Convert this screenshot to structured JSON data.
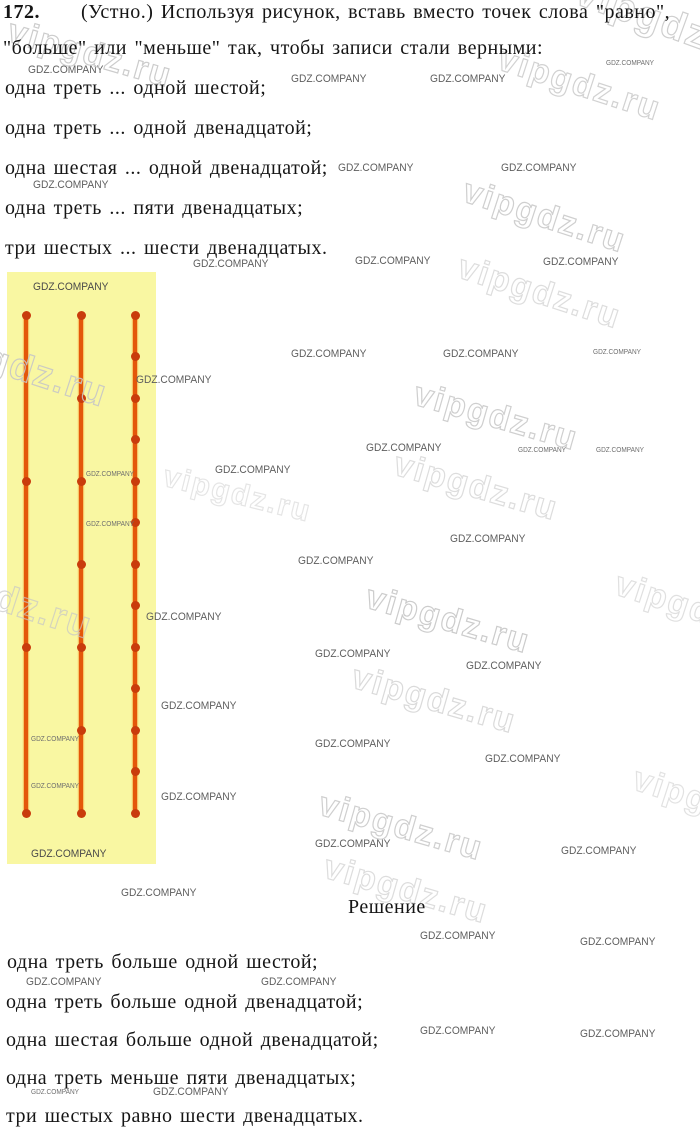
{
  "page": {
    "problem_number": "172.",
    "header_line1": "(Устно.) Используя рисунок, вставь вместо точек слова \"равно\",",
    "header_line2": "\"больше\" или \"меньше\" так, чтобы записи стали верными:",
    "conditions": [
      "одна треть ... одной шестой;",
      "одна треть ... одной двенадцатой;",
      "одна шестая ... одной двенадцатой;",
      "одна треть ... пяти двенадцатых;",
      "три шестых ... шести двенадцатых."
    ],
    "solution_title": "Решение",
    "solutions": [
      "одна треть больше одной шестой;",
      "одна треть больше одной двенадцатой;",
      "одна шестая больше одной двенадцатой;",
      "одна треть меньше пяти двенадцатых;",
      "три шестых равно шести двенадцатых."
    ]
  },
  "figure": {
    "description": "three vertical number lines of equal length divided by dots into thirds, sixths and twelfths",
    "background_color": "#f9f7a2",
    "line_color": "#e4570a",
    "dot_color": "#c93c0c",
    "line_x_centers": [
      19,
      74,
      128
    ],
    "line_top": 43,
    "line_length": 498,
    "lines": [
      {
        "name": "thirds-line",
        "divisions": 3
      },
      {
        "name": "sixths-line",
        "divisions": 6
      },
      {
        "name": "twelfths-line",
        "divisions": 12
      }
    ]
  },
  "watermarks": {
    "company": "GDZ.COMPANY",
    "site": "vipgdz.ru",
    "company_stamps": [
      {
        "x": 28,
        "y": 64,
        "size": "n"
      },
      {
        "x": 291,
        "y": 73,
        "size": "n"
      },
      {
        "x": 430,
        "y": 73,
        "size": "n"
      },
      {
        "x": 606,
        "y": 60,
        "size": "s"
      },
      {
        "x": 338,
        "y": 162,
        "size": "n"
      },
      {
        "x": 501,
        "y": 162,
        "size": "n"
      },
      {
        "x": 33,
        "y": 179,
        "size": "n"
      },
      {
        "x": 193,
        "y": 258,
        "size": "n"
      },
      {
        "x": 355,
        "y": 255,
        "size": "n"
      },
      {
        "x": 543,
        "y": 256,
        "size": "n"
      },
      {
        "x": 33,
        "y": 281,
        "size": "n",
        "dark": true
      },
      {
        "x": 291,
        "y": 348,
        "size": "n"
      },
      {
        "x": 443,
        "y": 348,
        "size": "n"
      },
      {
        "x": 593,
        "y": 349,
        "size": "s"
      },
      {
        "x": 136,
        "y": 374,
        "size": "n"
      },
      {
        "x": 366,
        "y": 442,
        "size": "n"
      },
      {
        "x": 518,
        "y": 447,
        "size": "s"
      },
      {
        "x": 596,
        "y": 447,
        "size": "s"
      },
      {
        "x": 215,
        "y": 464,
        "size": "n"
      },
      {
        "x": 86,
        "y": 471,
        "size": "s"
      },
      {
        "x": 86,
        "y": 521,
        "size": "s"
      },
      {
        "x": 450,
        "y": 533,
        "size": "n"
      },
      {
        "x": 298,
        "y": 555,
        "size": "n"
      },
      {
        "x": 146,
        "y": 611,
        "size": "n"
      },
      {
        "x": 315,
        "y": 648,
        "size": "n"
      },
      {
        "x": 466,
        "y": 660,
        "size": "n"
      },
      {
        "x": 161,
        "y": 700,
        "size": "n"
      },
      {
        "x": 31,
        "y": 736,
        "size": "s"
      },
      {
        "x": 315,
        "y": 738,
        "size": "n"
      },
      {
        "x": 485,
        "y": 753,
        "size": "n"
      },
      {
        "x": 31,
        "y": 783,
        "size": "s"
      },
      {
        "x": 161,
        "y": 791,
        "size": "n"
      },
      {
        "x": 315,
        "y": 838,
        "size": "n"
      },
      {
        "x": 561,
        "y": 845,
        "size": "n"
      },
      {
        "x": 31,
        "y": 848,
        "size": "n",
        "dark": true
      },
      {
        "x": 121,
        "y": 887,
        "size": "n"
      },
      {
        "x": 420,
        "y": 930,
        "size": "n"
      },
      {
        "x": 580,
        "y": 936,
        "size": "n"
      },
      {
        "x": 26,
        "y": 976,
        "size": "n"
      },
      {
        "x": 261,
        "y": 976,
        "size": "n"
      },
      {
        "x": 420,
        "y": 1025,
        "size": "n"
      },
      {
        "x": 580,
        "y": 1028,
        "size": "n"
      },
      {
        "x": 31,
        "y": 1089,
        "size": "s"
      },
      {
        "x": 153,
        "y": 1086,
        "size": "n"
      }
    ],
    "site_stamps": [
      {
        "x": 14,
        "y": 12,
        "rot": 16,
        "size": 34,
        "opacity": 0.9
      },
      {
        "x": 585,
        "y": -30,
        "rot": 20,
        "size": 40,
        "opacity": 0.85
      },
      {
        "x": 505,
        "y": 40,
        "rot": 18,
        "size": 34,
        "opacity": 0.8
      },
      {
        "x": 470,
        "y": 172,
        "rot": 18,
        "size": 34,
        "opacity": 0.85
      },
      {
        "x": 465,
        "y": 248,
        "rot": 18,
        "size": 34,
        "opacity": 0.6
      },
      {
        "x": -65,
        "y": 318,
        "rot": 18,
        "size": 38,
        "opacity": 0.9
      },
      {
        "x": -80,
        "y": 550,
        "rot": 18,
        "size": 38,
        "opacity": 0.7
      },
      {
        "x": 420,
        "y": 375,
        "rot": 16,
        "size": 34,
        "opacity": 0.85
      },
      {
        "x": 400,
        "y": 445,
        "rot": 16,
        "size": 34,
        "opacity": 0.6
      },
      {
        "x": 168,
        "y": 460,
        "rot": 14,
        "size": 30,
        "opacity": 0.45
      },
      {
        "x": 372,
        "y": 578,
        "rot": 16,
        "size": 34,
        "opacity": 0.9
      },
      {
        "x": 358,
        "y": 658,
        "rot": 16,
        "size": 34,
        "opacity": 0.65
      },
      {
        "x": 622,
        "y": 565,
        "rot": 18,
        "size": 34,
        "opacity": 0.55
      },
      {
        "x": 325,
        "y": 785,
        "rot": 16,
        "size": 34,
        "opacity": 0.85
      },
      {
        "x": 640,
        "y": 760,
        "rot": 18,
        "size": 34,
        "opacity": 0.5
      },
      {
        "x": 330,
        "y": 848,
        "rot": 16,
        "size": 34,
        "opacity": 0.6
      }
    ]
  }
}
